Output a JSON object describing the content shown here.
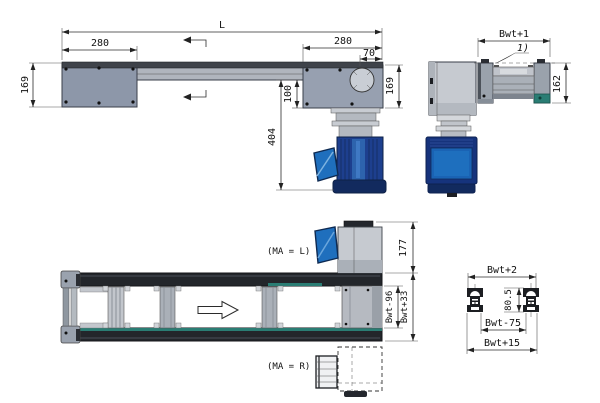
{
  "side_view": {
    "dims": {
      "overall": "L",
      "tail_length": "280",
      "drive_length": "280",
      "shaft_offset": "70",
      "height_left": "169",
      "height_right": "169",
      "axis_drop": "100",
      "motor_drop": "404"
    }
  },
  "end_view": {
    "dims": {
      "width": "Bwt+1",
      "height": "162"
    },
    "note_ref": "1)"
  },
  "top_view": {
    "labels": {
      "ma_left": "(MA = L)",
      "ma_right": "(MA = R)"
    },
    "dims": {
      "motor_height": "177",
      "width_inner": "Bwt-96",
      "width_outer": "Bwt+33"
    }
  },
  "profile_view": {
    "dims": {
      "width_top": "Bwt+2",
      "height": "80.5",
      "width_inner": "Bwt-75",
      "width_outer": "Bwt+15"
    }
  },
  "colors": {
    "motor_navy": "#16337c",
    "motor_blue": "#1e6fbe",
    "teal_accent": "#2a7d74",
    "frame_dark": "#23262b",
    "housing_gray": "#8d97a9",
    "dim_line": "#2b2b2b"
  }
}
